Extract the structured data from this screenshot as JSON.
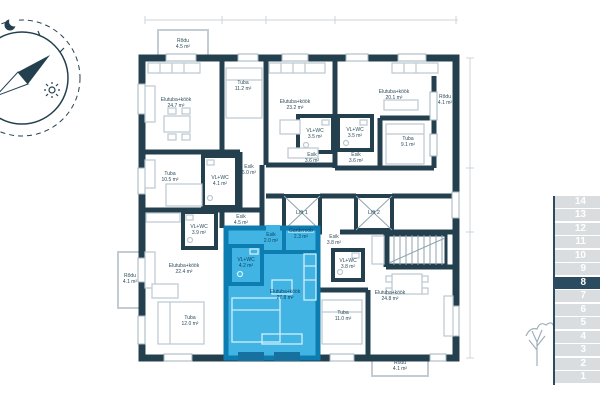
{
  "floor_selector": {
    "floors": [
      "14",
      "13",
      "12",
      "11",
      "10",
      "9",
      "8",
      "7",
      "6",
      "5",
      "4",
      "3",
      "2",
      "1"
    ],
    "selected": "8",
    "row_color": "#d9dde0",
    "selected_color": "#2a4b60",
    "number_color": "#ffffff"
  },
  "plan": {
    "wall_color": "#24404f",
    "highlight_color": "#41b4e4",
    "highlight_wall_color": "#0d7cb0",
    "lifts": [
      {
        "label": "Lift 1"
      },
      {
        "label": "Lift 2"
      }
    ],
    "rooms": [
      {
        "name": "Rõdu",
        "area": "4.5 m²"
      },
      {
        "name": "Elutuba+köök",
        "area": "24.7 m²"
      },
      {
        "name": "Tuba",
        "area": "11.2 m²"
      },
      {
        "name": "Elutuba+köök",
        "area": "23.2 m²"
      },
      {
        "name": "VL+WC",
        "area": "3.5 m²"
      },
      {
        "name": "Esik",
        "area": "3.6 m²"
      },
      {
        "name": "Elutuba+köök",
        "area": "20.1 m²"
      },
      {
        "name": "VL+WC",
        "area": "3.5 m²"
      },
      {
        "name": "Esik",
        "area": "3.6 m²"
      },
      {
        "name": "Tuba",
        "area": "9.1 m²"
      },
      {
        "name": "Rõdu",
        "area": "4.1 m²"
      },
      {
        "name": "Tuba",
        "area": "10.5 m²"
      },
      {
        "name": "VL+WC",
        "area": "4.1 m²"
      },
      {
        "name": "Esik",
        "area": "6.0 m²"
      },
      {
        "name": "Esik",
        "area": "4.5 m²"
      },
      {
        "name": "VL+WC",
        "area": "3.9 m²"
      },
      {
        "name": "Elutuba+köök",
        "area": "22.4 m²"
      },
      {
        "name": "Tuba",
        "area": "12.0 m²"
      },
      {
        "name": "Rõdu",
        "area": "4.1 m²"
      },
      {
        "name": "Esik",
        "area": "2.0 m²"
      },
      {
        "name": "Garderoob",
        "area": "2.3 m²"
      },
      {
        "name": "VL+WC",
        "area": "4.2 m²"
      },
      {
        "name": "Elutuba+köök",
        "area": "27.8 m²"
      },
      {
        "name": "Esik",
        "area": "3.8 m²"
      },
      {
        "name": "VL+WC",
        "area": "3.8 m²"
      },
      {
        "name": "Elutuba+köök",
        "area": "24.8 m²"
      },
      {
        "name": "Tuba",
        "area": "11.0 m²"
      },
      {
        "name": "Rõdu",
        "area": "4.1 m²"
      }
    ]
  },
  "icons": {
    "compass": "compass-rose",
    "moon": "crescent-moon",
    "sun": "sun",
    "tree": "tree"
  }
}
